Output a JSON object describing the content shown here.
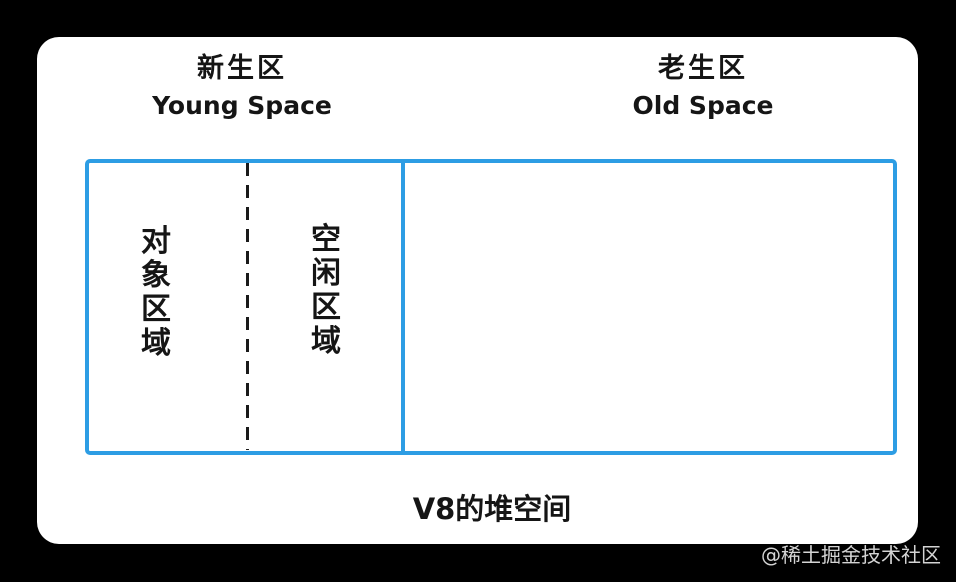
{
  "colors": {
    "page_bg": "#000000",
    "card_bg": "#ffffff",
    "box_border": "#2d9de4",
    "diagram_text": "#151515",
    "dash": "#1a1a1a",
    "watermark": "#d4d4d4"
  },
  "headers": {
    "young": {
      "zh": "新生区",
      "en": "Young Space"
    },
    "old": {
      "zh": "老生区",
      "en": "Old Space"
    }
  },
  "young_space": {
    "object_area_label": "对象区域",
    "free_area_label": "空闲区域"
  },
  "caption": "V8的堆空间",
  "watermark": "@稀土掘金技术社区"
}
